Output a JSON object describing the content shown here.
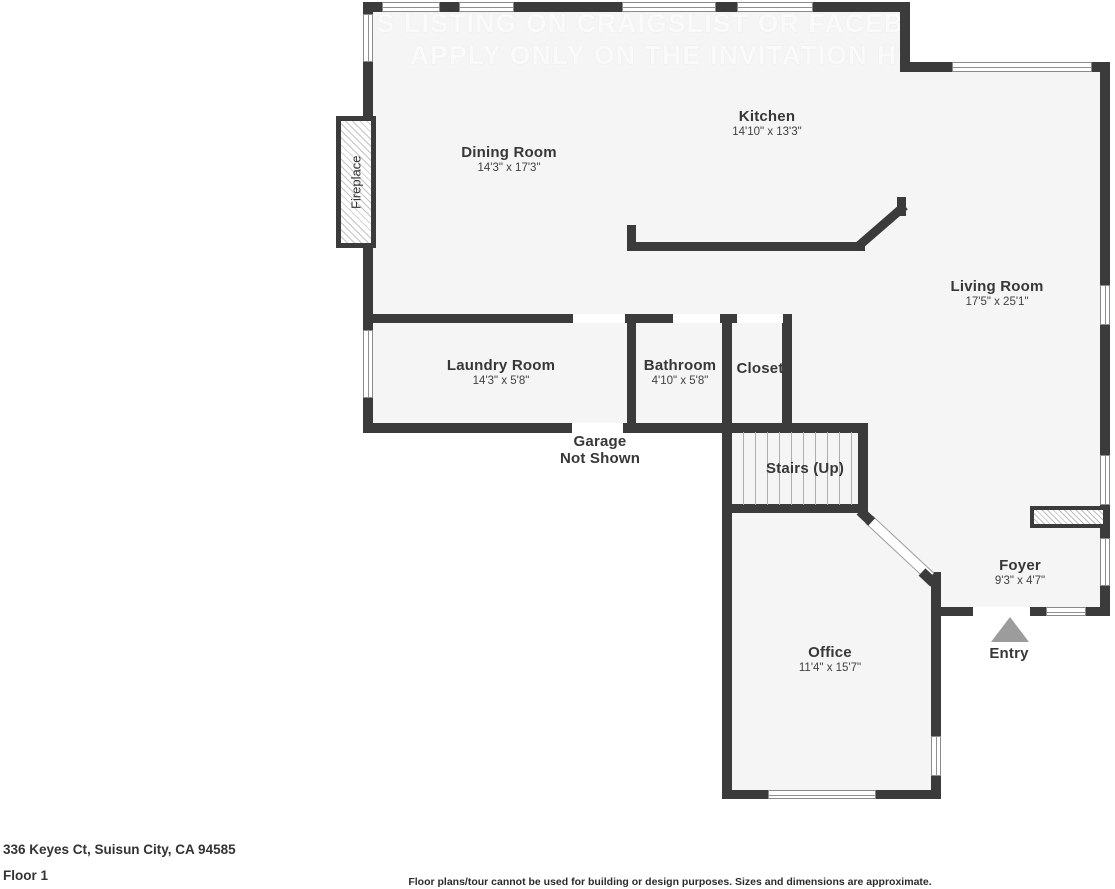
{
  "watermark": {
    "line1": "IS LISTING ON CRAIGSLIST OR FACEBOOK M",
    "line2": "APPLY ONLY ON THE INVITATION HOMES"
  },
  "rooms": {
    "kitchen": {
      "name": "Kitchen",
      "dims": "14'10\" x 13'3\""
    },
    "dining": {
      "name": "Dining Room",
      "dims": "14'3\" x 17'3\""
    },
    "living": {
      "name": "Living Room",
      "dims": "17'5\" x 25'1\""
    },
    "laundry": {
      "name": "Laundry Room",
      "dims": "14'3\" x 5'8\""
    },
    "bathroom": {
      "name": "Bathroom",
      "dims": "4'10\" x 5'8\""
    },
    "closet": {
      "name": "Closet"
    },
    "stairs": {
      "name": "Stairs (Up)"
    },
    "office": {
      "name": "Office",
      "dims": "11'4\" x 15'7\""
    },
    "foyer": {
      "name": "Foyer",
      "dims": "9'3\" x 4'7\""
    },
    "entry": {
      "name": "Entry"
    },
    "garage": {
      "line1": "Garage",
      "line2": "Not Shown"
    },
    "fireplace": {
      "name": "Fireplace"
    }
  },
  "footer": {
    "address": "336 Keyes Ct, Suisun City, CA 94585",
    "floor": "Floor 1",
    "disclaimer": "Floor plans/tour cannot be used for building or design purposes. Sizes and dimensions are approximate."
  },
  "colors": {
    "wall": "#3b3b3b",
    "floor": "#f5f5f5",
    "entry_arrow": "#9c9c9c"
  }
}
